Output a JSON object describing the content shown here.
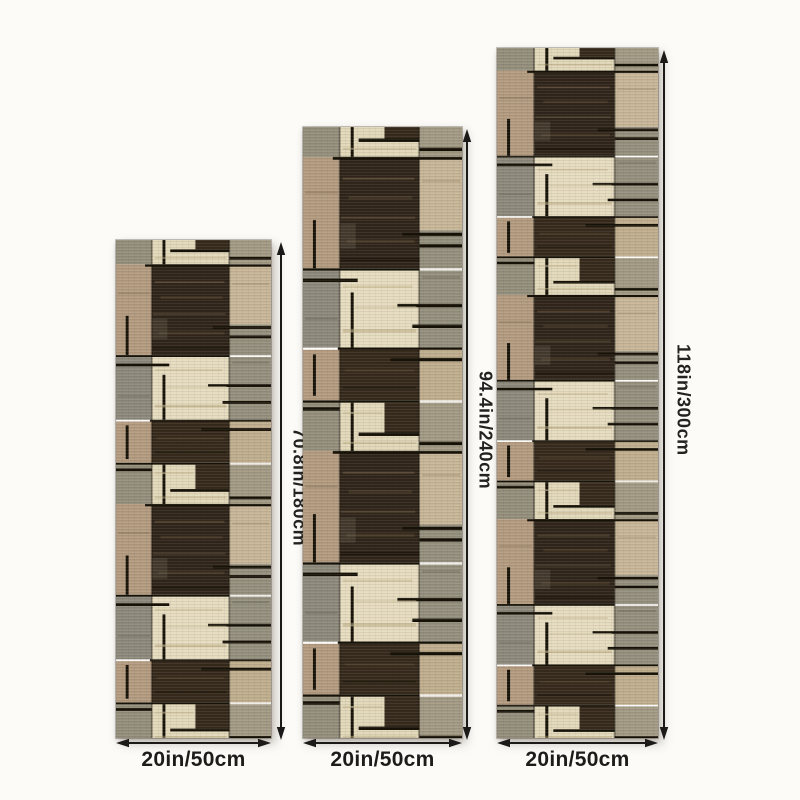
{
  "background_color": "#fcfbf8",
  "dimension_arrow_color": "#1b1a18",
  "dimension_label_color": "#1d1c1a",
  "rug_palette": {
    "tan": "#b39b80",
    "dark": "#30251a",
    "dark2": "#362a1c",
    "beige": "#c8b698",
    "beige2": "#c0ae8e",
    "beige3": "#a29a84",
    "gray": "#8d897c",
    "gray2": "#95907e",
    "gray3": "#948f7c",
    "cream": "#e6dcc0",
    "cream2": "#e2d8ba",
    "line": "#171208",
    "hl1": "#6d5a42",
    "hl2": "#55452f",
    "hl3": "#8a755c",
    "hl4": "#ab9878",
    "grayp": "#6b6154",
    "cs1": "#cabd97",
    "cs2": "#baab83",
    "gs1": "#6e6a5e"
  },
  "rugs": [
    {
      "position": "left",
      "length_label": "70.8in/180cm",
      "width_label": "20in/50cm"
    },
    {
      "position": "middle",
      "length_label": "94.4in/240cm",
      "width_label": "20in/50cm"
    },
    {
      "position": "right",
      "length_label": "118in/300cm",
      "width_label": "20in/50cm"
    }
  ]
}
